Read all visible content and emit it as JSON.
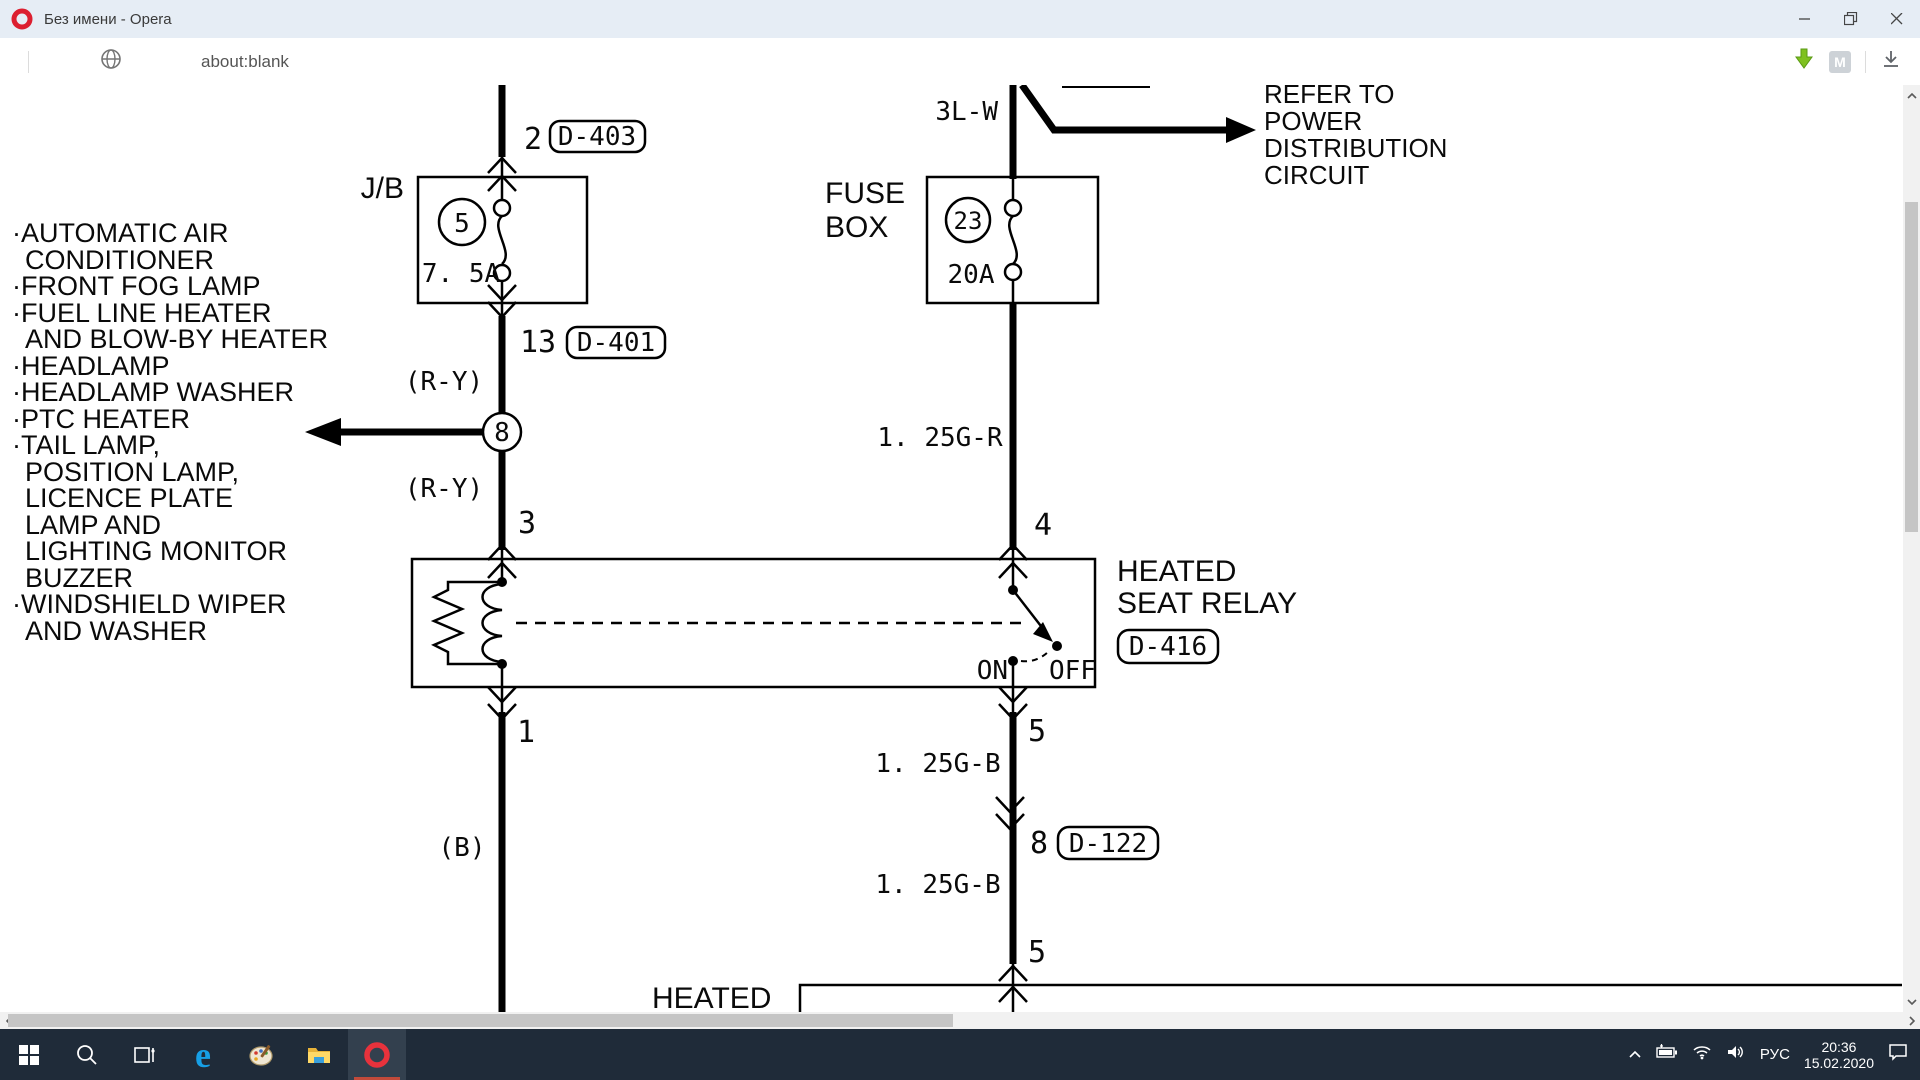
{
  "window": {
    "title": "Без имени - Opera"
  },
  "toolbar": {
    "url": "about:blank",
    "m_badge": "M"
  },
  "diagram": {
    "list": [
      "·AUTOMATIC AIR",
      "CONDITIONER",
      "·FRONT FOG LAMP",
      "·FUEL LINE HEATER",
      "AND BLOW-BY HEATER",
      "·HEADLAMP",
      "·HEADLAMP WASHER",
      "·PTC HEATER",
      "·TAIL LAMP,",
      "POSITION LAMP,",
      "LICENCE PLATE",
      "LAMP AND",
      "LIGHTING MONITOR",
      "BUZZER",
      "·WINDSHIELD WIPER",
      "AND WASHER"
    ],
    "pin2": "2",
    "d403": "D-403",
    "jb": "J/B",
    "fuse5": "5",
    "amp75": "7. 5A",
    "pin13": "13",
    "d401": "D-401",
    "ry1": "(R-Y)",
    "splice8": "8",
    "ry2": "(R-Y)",
    "pin3": "3",
    "w3lw": "3L-W",
    "fuse_line1": "FUSE",
    "fuse_line2": "BOX",
    "fuse23": "23",
    "amp20": "20A",
    "refer": [
      "REFER TO",
      "POWER",
      "DISTRIBUTION",
      "CIRCUIT"
    ],
    "gr": "1. 25G-R",
    "pin4": "4",
    "relay1": "HEATED",
    "relay2": "SEAT RELAY",
    "d416": "D-416",
    "on": "ON",
    "off": "OFF",
    "pin1": "1",
    "wb": "(B)",
    "pin5a": "5",
    "gb1": "1. 25G-B",
    "pin8": "8",
    "d122": "D-122",
    "gb2": "1. 25G-B",
    "pin5b": "5",
    "heated": "HEATED"
  },
  "taskbar": {
    "lang": "РУС",
    "time": "20:36",
    "date": "15.02.2020"
  }
}
